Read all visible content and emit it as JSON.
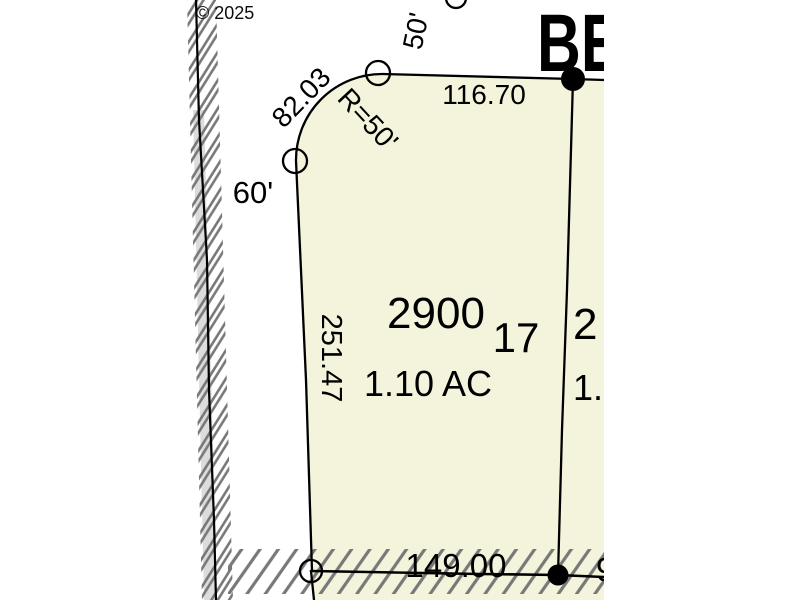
{
  "map": {
    "copyright": "© 2025",
    "street": {
      "name_partial": "BE"
    },
    "colors": {
      "parcel_fill": "#f4f4dc",
      "taxlot_number_blue": "#2070dd",
      "boundary_black": "#000000",
      "hatch_gray": "#787878",
      "road_band_gray": "#dcdcdc",
      "copyright_gray": "#a6a6a6"
    },
    "parcel": {
      "taxlot_number": "2900",
      "lot_number": "17",
      "area": "1.10 AC"
    },
    "adjacent_parcel": {
      "taxlot_number_partial": "2",
      "area_partial": "1."
    },
    "dimensions": {
      "north_boundary": "116.70",
      "south_boundary": "149.00",
      "west_boundary": "251.47",
      "curve_length": "82.03",
      "curve_radius": "R=50'",
      "street_half_width": "50'",
      "road_width": "60'",
      "south_east_partial": "9"
    }
  }
}
